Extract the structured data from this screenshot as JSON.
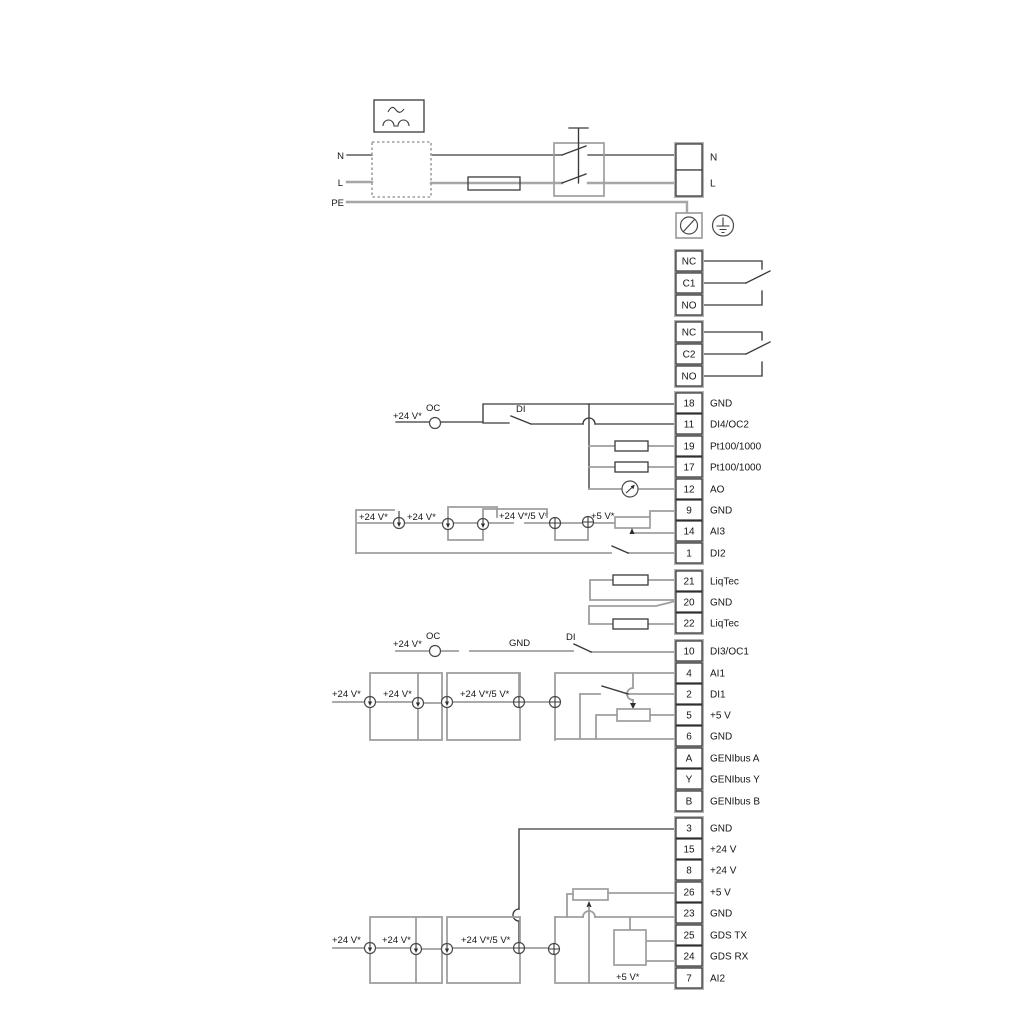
{
  "diagram_title": "Pump wiring diagram",
  "colors": {
    "background": "#ffffff",
    "wire_dark": "#3a3a3a",
    "wire_gray": "#9e9e9e",
    "terminal_backing": "#b3b3b3",
    "text": "#161616"
  },
  "power": {
    "n": "N",
    "l": "L",
    "pe": "PE",
    "n_right": "N",
    "l_right": "L"
  },
  "labels": {
    "v24": "+24 V*",
    "v24_5": "+24 V*/5 V*",
    "v5": "+5 V*",
    "oc": "OC",
    "di": "DI",
    "gnd": "GND"
  },
  "terminal_groups": [
    {
      "name": "mains",
      "cell_h": 26,
      "centers": [
        157,
        183
      ],
      "cells": [
        {
          "num": "",
          "label": "N"
        },
        {
          "num": "",
          "label": "L"
        }
      ]
    },
    {
      "name": "relay-1",
      "cell_h": 20,
      "centers": [
        261,
        283,
        305
      ],
      "cells": [
        {
          "num": "NC",
          "label": ""
        },
        {
          "num": "C1",
          "label": ""
        },
        {
          "num": "NO",
          "label": ""
        }
      ]
    },
    {
      "name": "relay-2",
      "cell_h": 20,
      "centers": [
        332,
        354,
        376
      ],
      "cells": [
        {
          "num": "NC",
          "label": ""
        },
        {
          "num": "C2",
          "label": ""
        },
        {
          "num": "NO",
          "label": ""
        }
      ]
    },
    {
      "name": "io-1",
      "cell_h": 20,
      "centers": [
        403,
        424,
        446,
        467,
        489,
        510,
        531,
        553
      ],
      "cells": [
        {
          "num": "18",
          "label": "GND"
        },
        {
          "num": "11",
          "label": "DI4/OC2"
        },
        {
          "num": "19",
          "label": "Pt100/1000"
        },
        {
          "num": "17",
          "label": "Pt100/1000"
        },
        {
          "num": "12",
          "label": "AO"
        },
        {
          "num": "9",
          "label": "GND"
        },
        {
          "num": "14",
          "label": "AI3"
        },
        {
          "num": "1",
          "label": "DI2"
        }
      ]
    },
    {
      "name": "liqtec",
      "cell_h": 20,
      "centers": [
        581,
        602,
        623
      ],
      "cells": [
        {
          "num": "21",
          "label": "LiqTec"
        },
        {
          "num": "20",
          "label": "GND"
        },
        {
          "num": "22",
          "label": "LiqTec"
        }
      ]
    },
    {
      "name": "io-2",
      "cell_h": 20,
      "centers": [
        651,
        673,
        694,
        715,
        736,
        758,
        779,
        801
      ],
      "cells": [
        {
          "num": "10",
          "label": "DI3/OC1"
        },
        {
          "num": "4",
          "label": "AI1"
        },
        {
          "num": "2",
          "label": "DI1"
        },
        {
          "num": "5",
          "label": "+5 V"
        },
        {
          "num": "6",
          "label": "GND"
        },
        {
          "num": "A",
          "label": "GENIbus A"
        },
        {
          "num": "Y",
          "label": "GENIbus Y"
        },
        {
          "num": "B",
          "label": "GENIbus B"
        }
      ]
    },
    {
      "name": "io-3",
      "cell_h": 20,
      "centers": [
        828,
        849,
        870,
        892,
        913,
        935,
        956,
        978
      ],
      "cells": [
        {
          "num": "3",
          "label": "GND"
        },
        {
          "num": "15",
          "label": "+24 V"
        },
        {
          "num": "8",
          "label": "+24 V"
        },
        {
          "num": "26",
          "label": "+5 V"
        },
        {
          "num": "23",
          "label": "GND"
        },
        {
          "num": "25",
          "label": "GDS TX"
        },
        {
          "num": "24",
          "label": "GDS RX"
        },
        {
          "num": "7",
          "label": "AI2"
        }
      ]
    }
  ]
}
